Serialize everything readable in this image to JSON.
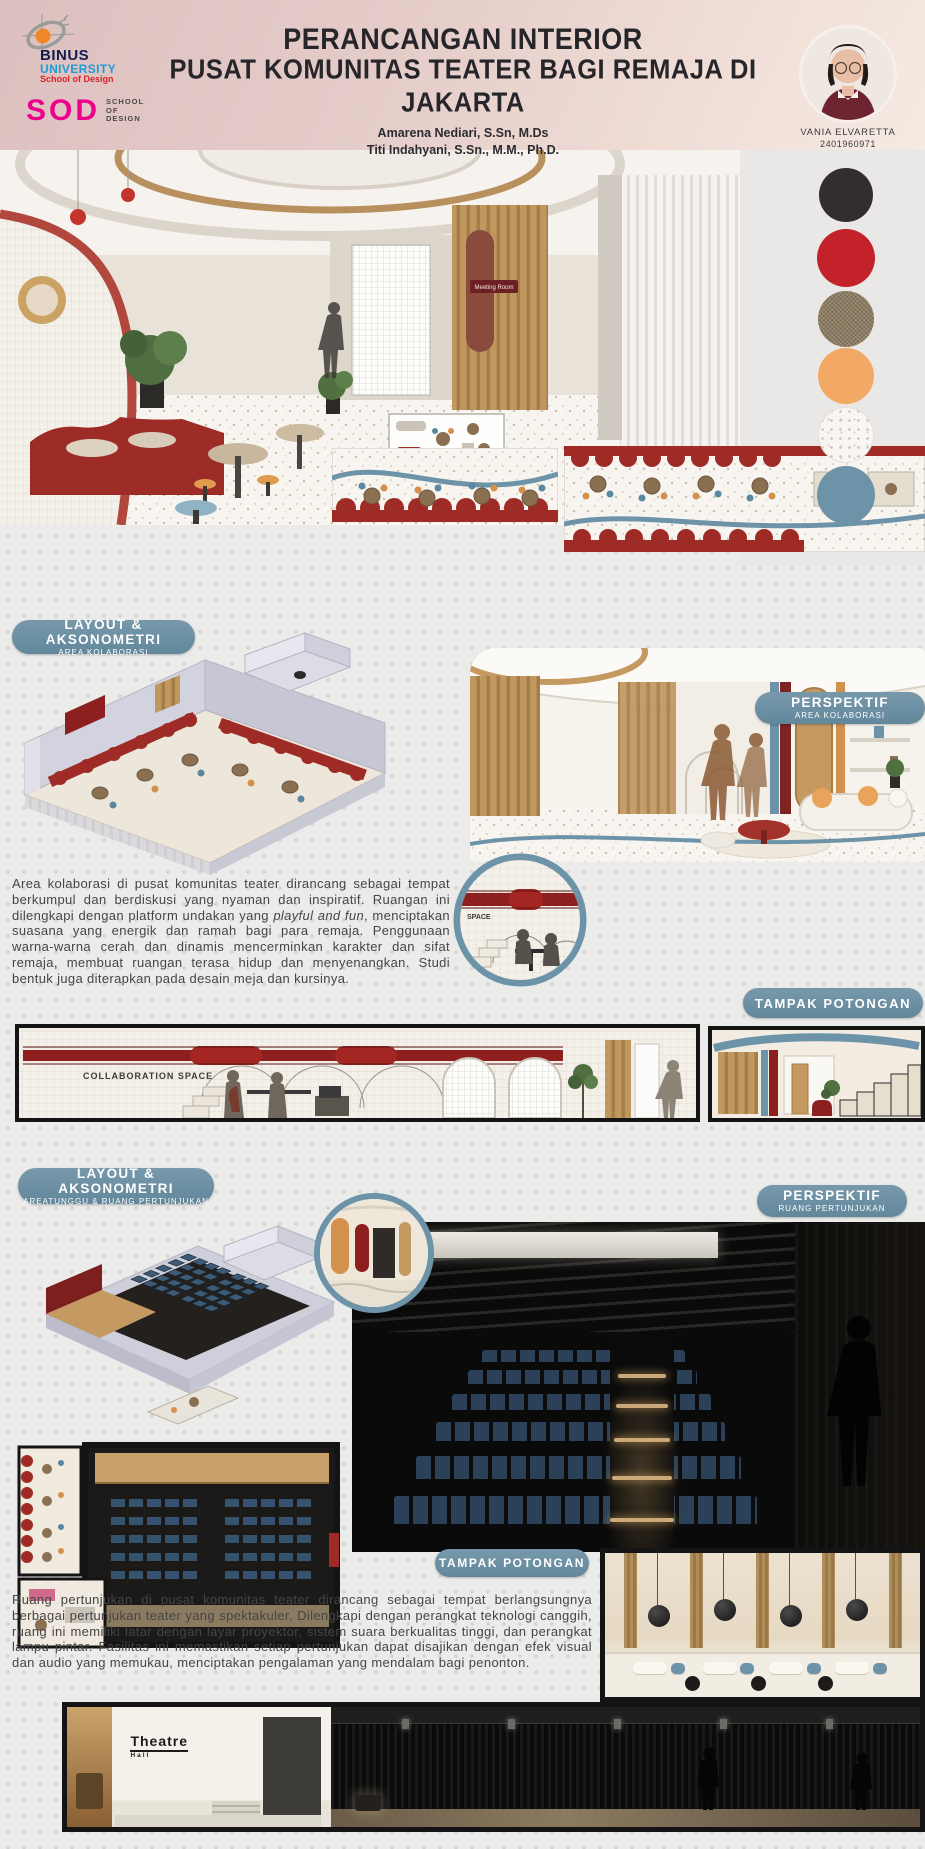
{
  "header": {
    "title_line1": "PERANCANGAN INTERIOR",
    "title_line2": "PUSAT KOMUNITAS TEATER BAGI REMAJA DI JAKARTA",
    "authors": [
      "Amarena Nediari, S.Sn, M.Ds",
      "Titi Indahyani, S.Sn., M.M., Ph.D."
    ],
    "binus_logo": {
      "line1": "BINUS",
      "line2": "UNIVERSITY",
      "line3": "School of Design"
    },
    "sod_logo": {
      "acronym": "SOD",
      "line1": "SCHOOL",
      "line2": "OF",
      "line3": "DESIGN"
    },
    "student": {
      "name": "VANIA ELVARETTA",
      "id": "2401960971"
    }
  },
  "material_palette": {
    "swatches": [
      {
        "name": "charcoal-black",
        "color": "#332E2D"
      },
      {
        "name": "theater-red",
        "color": "#C4222A"
      },
      {
        "name": "taupe-linen",
        "color": "#8B7B61"
      },
      {
        "name": "warm-orange",
        "color": "#F2A964"
      },
      {
        "name": "white-terrazzo",
        "color": "#F8F6F2"
      },
      {
        "name": "steel-blue",
        "color": "#6D93A8"
      }
    ]
  },
  "collaboration_section": {
    "layout_pill_line1": "LAYOUT & AKSONOMETRI",
    "layout_pill_line2": "AREA KOLABORASI",
    "perspective_pill_line1": "PERSPEKTIF",
    "perspective_pill_line2": "AREA KOLABORASI",
    "section_pill": "TAMPAK POTONGAN",
    "paragraph_part1": "Area kolaborasi di pusat komunitas teater dirancang sebagai tempat berkumpul dan berdiskusi yang nyaman dan inspiratif. Ruangan ini dilengkapi dengan platform undakan yang ",
    "paragraph_italic": "playful and fun",
    "paragraph_part2": ", menciptakan suasana yang energik dan ramah bagi para remaja. Penggunaan warna-warna cerah dan dinamis mencerminkan karakter dan sifat remaja, membuat ruangan terasa hidup dan menyenangkan. Studi bentuk juga diterapkan pada desain meja dan kursinya.",
    "elevation_label": "COLLABORATION SPACE",
    "inset_label": "SPACE",
    "hero_sign": "Meeting Room"
  },
  "theater_section": {
    "layout_pill_line1": "LAYOUT & AKSONOMETRI",
    "layout_pill_line2": "AREATUNGGU & RUANG PERTUNJUKAN",
    "perspective_pill_line1": "PERSPEKTIF",
    "perspective_pill_line2": "RUANG PERTUNJUKAN",
    "section_pill": "TAMPAK POTONGAN",
    "paragraph": "Ruang pertunjukan di pusat komunitas teater dirancang sebagai tempat berlangsungnya berbagai pertunjukan teater yang spektakuler. Dilengkapi dengan perangkat teknologi canggih, ruang ini memiliki latar dengan layar proyektor, sistem suara berkualitas tinggi, dan perangkat lampu pintar. Fasilitas ini memastikan setiap pertunjukan dapat disajikan dengan efek visual dan audio yang memukau, menciptakan pengalaman yang mendalam bagi penonton.",
    "bottom_sign_line1": "Theatre",
    "bottom_sign_line2": "Hall"
  }
}
